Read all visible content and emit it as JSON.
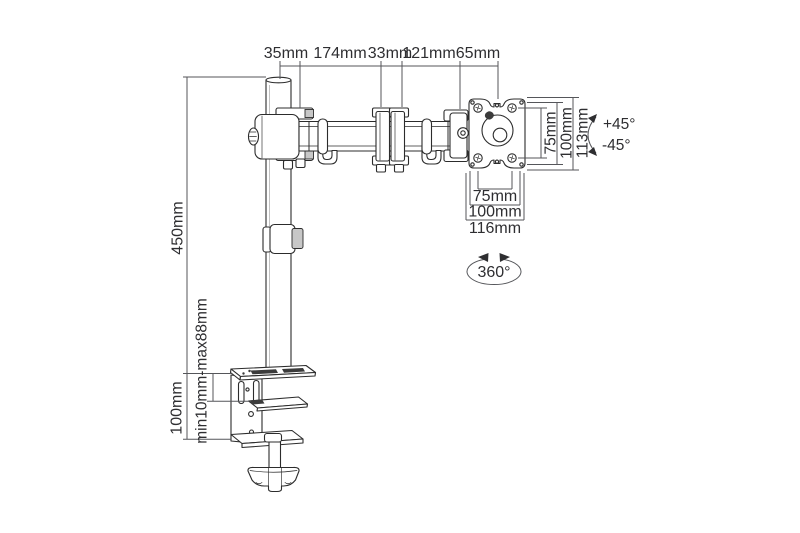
{
  "drawing": {
    "background": "#ffffff",
    "line_color": "#2c2c2c",
    "dimension_line_color": "#55565a",
    "dims": {
      "top": [
        "35mm",
        "174mm",
        "33mm",
        "121mm",
        "65mm"
      ],
      "vesa_vertical": [
        "75mm",
        "100mm",
        "113mm"
      ],
      "tilt_up": "+45°",
      "tilt_down": "-45°",
      "vesa_horizontal": [
        "75mm",
        "100mm",
        "116mm"
      ],
      "swivel": "360°",
      "pole_height": "450mm",
      "clamp_height": "100mm",
      "clamp_grip_range": "min10mm-max88mm"
    }
  }
}
